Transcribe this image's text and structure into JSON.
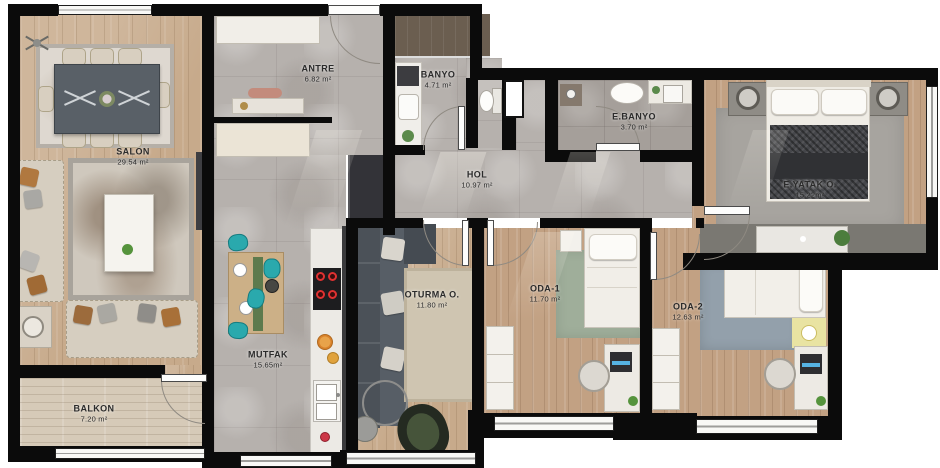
{
  "rooms": {
    "salon": {
      "name": "SALON",
      "area": "29.54 m²"
    },
    "antre": {
      "name": "ANTRE",
      "area": "6.82 m²"
    },
    "banyo": {
      "name": "BANYO",
      "area": "4.71 m²"
    },
    "ebanyo": {
      "name": "E.BANYO",
      "area": "3.70 m²"
    },
    "hol": {
      "name": "HOL",
      "area": "10.97 m²"
    },
    "eyatak": {
      "name": "E.YATAK O.",
      "area": "15.22m²"
    },
    "mutfak": {
      "name": "MUTFAK",
      "area": "15.65m²"
    },
    "balkon": {
      "name": "BALKON",
      "area": "7.20 m²"
    },
    "oturma": {
      "name": "OTURMA O.",
      "area": "11.80 m²"
    },
    "oda1": {
      "name": "ODA-1",
      "area": "11.70 m²"
    },
    "oda2": {
      "name": "ODA-2",
      "area": "12.63 m²"
    }
  },
  "colors": {
    "wall": "#0b0b0b",
    "tile": "#b6b1ad",
    "wood": "#c7aa8b",
    "teal": "#2aa9ad",
    "burner_red": "#e03131",
    "label": "#2b2b2b"
  }
}
